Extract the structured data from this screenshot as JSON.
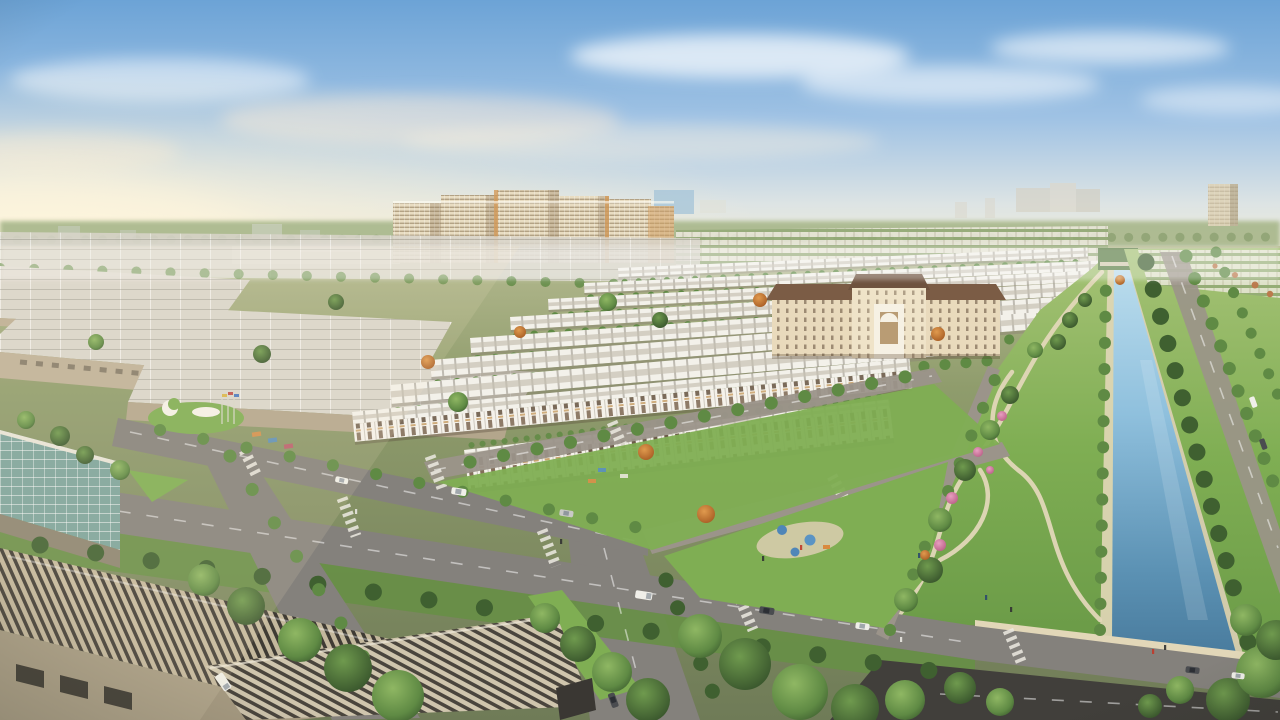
{
  "meta": {
    "title": "Aerial 3D rendering of a master-planned urban residential development",
    "description": "Photorealistic aerial render: rows of white townhouses and shophouses, cream apartment towers, a classical civic building, a long landscaped canal park with winding paths, tree-lined boulevards with crosswalks and cars, and an industrial warehouse district in the foreground under a soft hazy sky."
  },
  "scene": {
    "elements": [
      {
        "name": "sky",
        "description": "pale blue sky with soft clouds and warm sun haze on the left"
      },
      {
        "name": "horizon-treeline",
        "description": "hazy green tree horizon"
      },
      {
        "name": "distant-towers",
        "description": "faint high-rise blocks and a beige tower on the horizon"
      },
      {
        "name": "apartment-complex",
        "description": "cluster of cream mid-rise apartment towers"
      },
      {
        "name": "townhouse-rows",
        "description": "receding rows of white flat-roofed townhouses with green courtyards"
      },
      {
        "name": "shophouse-front-row",
        "description": "three-storey white shophouses with wood-toned openings and planted balconies"
      },
      {
        "name": "classical-building",
        "description": "beige civic building with brown hip roof and arched portico"
      },
      {
        "name": "canal",
        "description": "long straight light-blue canal widening toward the viewer"
      },
      {
        "name": "canal-park",
        "description": "green linear park with winding tan footpaths and flower bushes"
      },
      {
        "name": "right-avenue",
        "description": "tree-lined avenue right of the canal"
      },
      {
        "name": "bridge-road",
        "description": "road crossing the canal in the foreground"
      },
      {
        "name": "road-network",
        "description": "asphalt boulevards with zebra crosswalks, lane dashes and median greens"
      },
      {
        "name": "entrance-plaza",
        "description": "white sculptural canopies and flags on a lawn"
      },
      {
        "name": "pocket-park",
        "description": "playground lawn with blue canopies"
      },
      {
        "name": "industrial-sheds",
        "description": "large light-gray factory roofs on the left"
      },
      {
        "name": "foreground-warehouses",
        "description": "striped corrugated warehouse roofs in the near foreground"
      },
      {
        "name": "glass-roof-building",
        "description": "teal gridded skylight roof at lower left"
      },
      {
        "name": "vehicles",
        "description": "cars and vans on the roads"
      },
      {
        "name": "pedestrians",
        "description": "tiny figures on paths and crossings"
      }
    ]
  },
  "colors": {
    "sky_top": "#6ca3d6",
    "sky_mid": "#9fc2e4",
    "sky_low": "#dde4e4",
    "sky_horizon": "#f5edd6",
    "sun_glow": "#fff6dd",
    "haze_warm": "#f7e9d4",
    "treeline": "#a9b88c",
    "treeline_dark": "#7e9563",
    "ground_top": "#b5ba90",
    "ground_mid": "#8f9c6c",
    "ground_low": "#6f7b57",
    "grass": "#7fae53",
    "grass_light": "#a3c275",
    "grass_dark": "#678f46",
    "green_mid": "#5f8a44",
    "green_deep": "#3f6030",
    "autumn_orange": "#c77e3d",
    "flower_pink": "#d873a2",
    "canal_top": "#c0e0ef",
    "canal_mid": "#8fc0dd",
    "canal_deep": "#487a9c",
    "path_tan": "#e2d7b8",
    "sand": "#d9cdae",
    "road": "#84817c",
    "road_light": "#9b948a",
    "road_dark": "#413f3b",
    "stripe_white": "#eceae2",
    "shed_roof": "#d9d5cb",
    "shed_wall": "#bcae93",
    "wh_stripe_light": "#c4b89d",
    "wh_stripe_dark": "#3f3b34",
    "wh_wall": "#a79b82",
    "glass_teal": "#7ca39b",
    "tower_cream": "#e8dcc1",
    "tower_shadow": "#bba684",
    "tower_accent": "#d29a5a",
    "window_tint": "#7d6748",
    "roof_white": "#f3f1ea",
    "roof_deck": "#c6c1b2",
    "facade_white": "#f5f2eb",
    "facade_wood": "#6e5740",
    "classical_wall": "#e9dabc",
    "classical_roof": "#7b5c45",
    "car_white": "#f0efe9",
    "car_dark": "#4a4c50"
  }
}
